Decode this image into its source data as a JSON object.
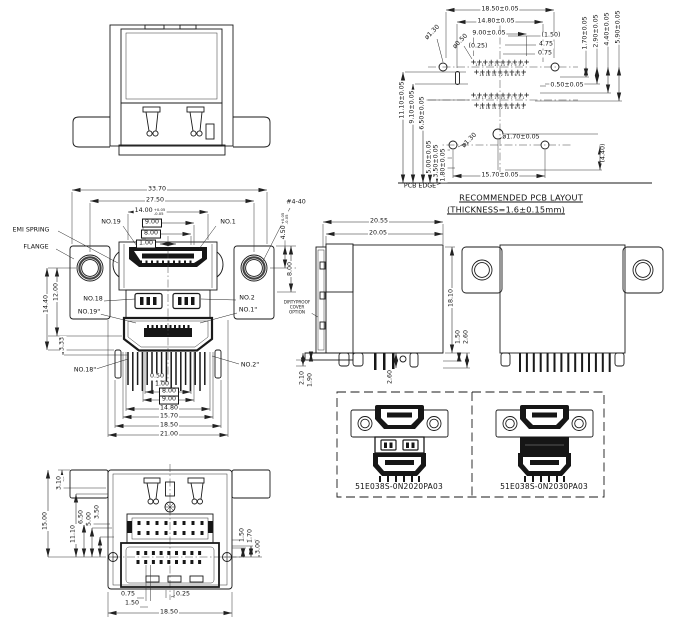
{
  "pcb_layout": {
    "title": "RECOMMENDED PCB LAYOUT",
    "subtitle": "(THICKNESS=1.6±0.15mm)",
    "pcb_edge_label": "PCB EDGE",
    "pins_odd_row": "19 17 15 13 11 9 7 5 3 1",
    "pins_even_row": "18 16 14 12 10 8 6 4 2",
    "dims": {
      "w_1850": "18.50±0.05",
      "w_1480": "14.80±0.05",
      "w_900": "9.00±0.05",
      "r_150": "(1.50)",
      "r_475": "4.75",
      "r_075": "0.75",
      "v_170": "1.70±0.05",
      "v_290": "2.90±0.05",
      "v_440": "4.40±0.05",
      "v_590": "5.90±0.05",
      "stagger_050": "0.50±0.05",
      "hole_130_top": "ø1.30",
      "hole_050": "ø0.50",
      "hole_025": "(0.25)",
      "l_1110": "11.10±0.05",
      "l_910": "9.10±0.05",
      "l_650": "6.50±0.05",
      "l_500": "5.00±0.05",
      "l_350": "3.50±0.05",
      "l_180": "1.80±0.05",
      "hole_130_bot": "ø1.30",
      "hole_170": "ø1.70±0.05",
      "v_440_ref": "(4.40)",
      "w_1570": "15.70±0.05"
    }
  },
  "front_view": {
    "callouts": {
      "emi_spring": "EMI SPRING",
      "flange": "FLANGE",
      "thread": "#4-40",
      "no19": "NO.19",
      "no1": "NO.1",
      "no18": "NO.18",
      "no2": "NO.2",
      "no19b": "NO.19\"",
      "no1b": "NO.1\"",
      "no18b": "NO.18\"",
      "no2b": "NO.2\"",
      "dirtyproof_line1": "DIRTYPROOF",
      "dirtyproof_line2": "COVER",
      "dirtyproof_line3": "OPTION"
    },
    "dims": {
      "w_3370": "33.70",
      "w_2750": "27.50",
      "w_1400": "14.00",
      "w_1400_tol_plus": "+0.05",
      "w_1400_tol_minus": "-0.05",
      "w_900_top": "9.00",
      "w_800_top": "8.00",
      "w_100": "1.00",
      "h_450": "4.50",
      "h_450_tol_plus": "+0.05",
      "h_450_tol_minus": "-0.05",
      "h_800": "8.00",
      "h_1200": "12.00",
      "h_1440": "14.40",
      "h_333": "3.33",
      "b_050": "0.50",
      "b_100": "1.00",
      "b_800": "8.00",
      "b_900": "9.00",
      "b_1480": "14.80",
      "b_1570": "15.70",
      "b_1850": "18.50",
      "b_2100": "21.00"
    }
  },
  "side_view": {
    "dims": {
      "w_2055": "20.55",
      "w_2005": "20.05",
      "h_1810": "18.10",
      "h_150": "1.50",
      "h_260": "2.60",
      "h_210": "2.10",
      "h_190": "1.90",
      "pin_260": "2.60"
    }
  },
  "bottom_view": {
    "dims": {
      "h_310": "3.10",
      "h_1500": "15.00",
      "h_1110": "11.10",
      "h_650": "6.50",
      "h_500": "5.00",
      "h_350": "3.50",
      "r_150": "1.50",
      "r_170": "1.70",
      "r_300": "3.00",
      "b_075": "0.75",
      "b_150": "1.50",
      "b_025": "0.25",
      "b_1850": "18.50"
    }
  },
  "products": {
    "part_number_left": "51E038S-0N2020PA03",
    "part_number_right": "51E038S-0N2030PA03"
  }
}
